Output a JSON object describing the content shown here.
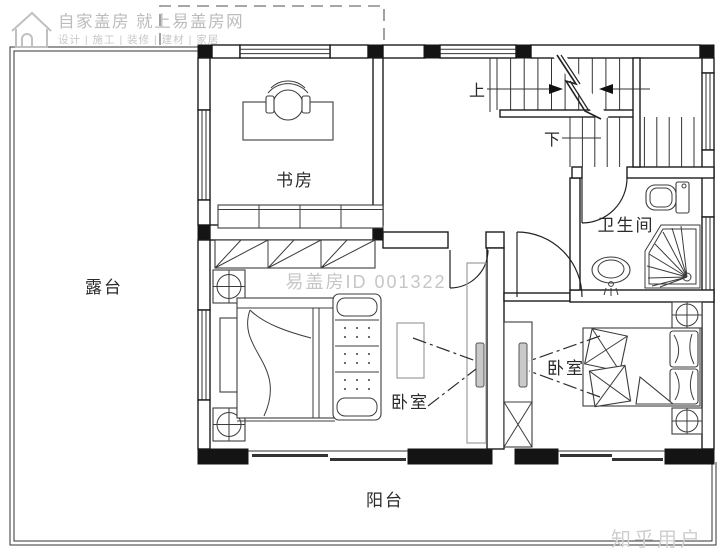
{
  "watermarks": {
    "logo_line1": "自家盖房 就上易盖房网",
    "logo_line2": "设计 | 施工 | 装修 | 建材 | 家居",
    "center_id": "易盖房ID 001322",
    "credit": "知乎用户"
  },
  "rooms": {
    "study": "书房",
    "terrace": "露台",
    "bathroom": "卫生间",
    "bedroom_left": "卧室",
    "bedroom_right": "卧室",
    "balcony": "阳台"
  },
  "stairs": {
    "up_label": "上",
    "down_label": "下"
  },
  "colors": {
    "wall_line": "#1c1c1c",
    "furniture_line": "#3c3c3c",
    "light_furniture": "#9c9c9c",
    "watermark_gray": "#c3c3c3"
  }
}
